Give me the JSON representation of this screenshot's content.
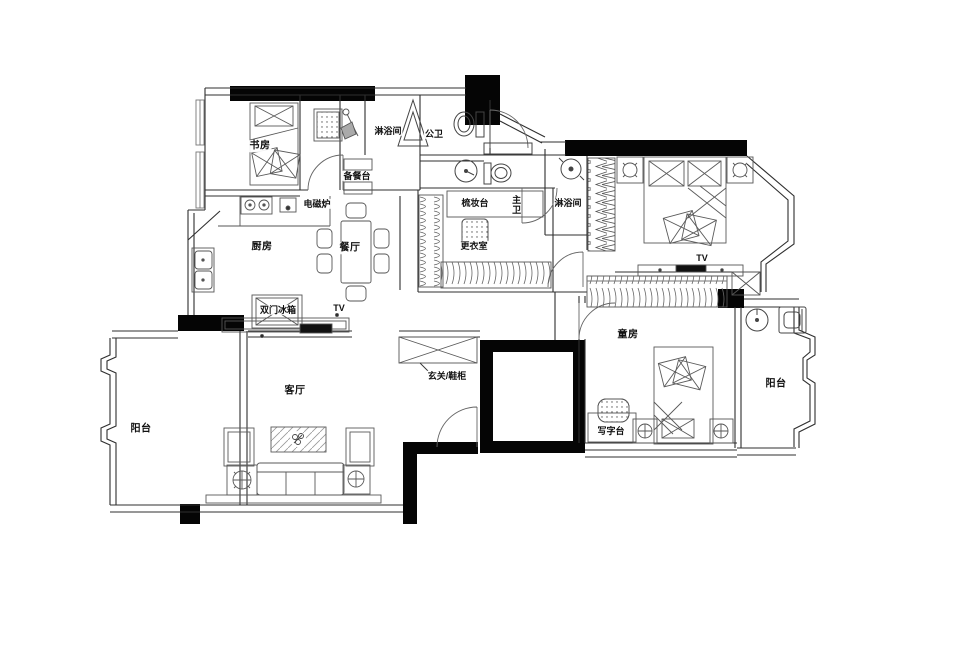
{
  "title": "apartment-floor-plan",
  "colors": {
    "background": "#ffffff",
    "wall": "#000000",
    "line": "#3c3c3c",
    "furniture": "#5a5a5a"
  },
  "rooms": {
    "study": {
      "label": "书房"
    },
    "shower_top": {
      "label": "淋浴间"
    },
    "guest_wc": {
      "label": "公卫"
    },
    "prep_counter": {
      "label": "备餐台"
    },
    "induction_cooker": {
      "label": "电磁炉"
    },
    "kitchen": {
      "label": "厨房"
    },
    "dining": {
      "label": "餐厅"
    },
    "vanity": {
      "label": "梳妆台"
    },
    "master_wc": {
      "label": "主卫"
    },
    "walkin_closet": {
      "label": "更衣室"
    },
    "shower_right": {
      "label": "淋浴间"
    },
    "master_tv": {
      "label": "TV"
    },
    "fridge": {
      "label": "双门冰箱"
    },
    "living_tv": {
      "label": "TV"
    },
    "foyer": {
      "label": "玄关/鞋柜"
    },
    "living": {
      "label": "客厅"
    },
    "balcony_left": {
      "label": "阳台"
    },
    "kids": {
      "label": "童房"
    },
    "desk": {
      "label": "写字台"
    },
    "balcony_right": {
      "label": "阳台"
    }
  }
}
